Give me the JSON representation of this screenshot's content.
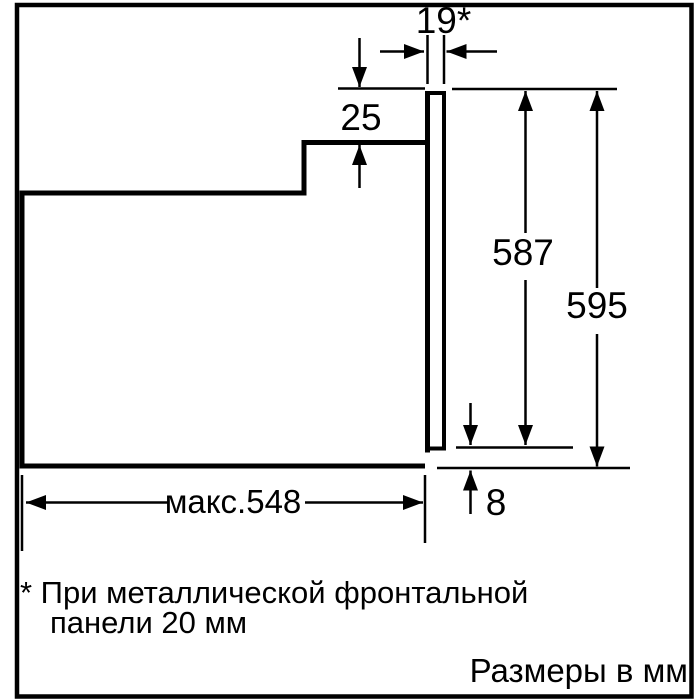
{
  "colors": {
    "ink": "#000000",
    "background": "#ffffff"
  },
  "diagram": {
    "kind": "built-in oven side-view dimension drawing",
    "dims": {
      "panel_thickness": "19*",
      "top_step": "25",
      "inner_height": "587",
      "total_height": "595",
      "max_depth": "макс.548",
      "bottom_gap": "8"
    },
    "footnote": {
      "line1": "* При металлической фронтальной",
      "line2": "панели 20 мм"
    },
    "units_caption": "Размеры в мм"
  }
}
